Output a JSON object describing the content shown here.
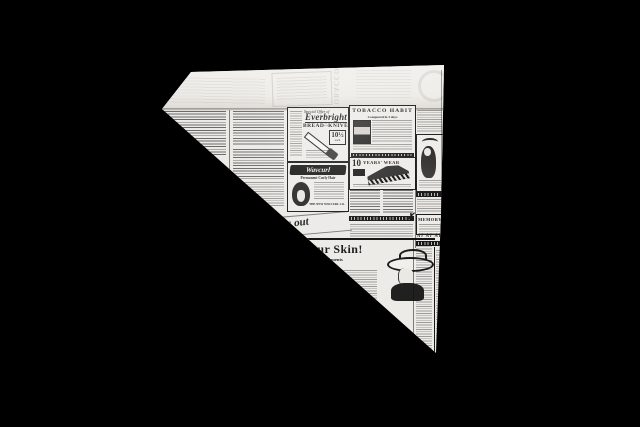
{
  "scene": {
    "description": "Triangular paper cone made of vintage newspaper print, standing on a black background",
    "colors": {
      "background": "#000000",
      "paper": "#eceae6",
      "flap": "#f2f0ec",
      "ink": "#1b1b1b"
    }
  },
  "newsprint": {
    "everbright_ad": {
      "offer": "Special Offer of",
      "brand": "Everbright",
      "title": "BREAD∴KNIVES",
      "price": "10½",
      "price_unit": "each"
    },
    "tobacco_ad": {
      "title": "TOBACCO HABIT",
      "subtitle": "Conquered in 3 days"
    },
    "wavcurl_ad": {
      "brand": "Wavcurl",
      "subtitle": "Permanent Curly Hair",
      "footer": "THE NEW WAVCURL CO."
    },
    "shoe_ad": {
      "number": "10",
      "title": "YEARS' WEAR"
    },
    "cutout_script": {
      "text": "is out"
    },
    "skin_ad": {
      "headline": "our Skin!",
      "line1": "ial Disfigurements",
      "line2": "mplexion",
      "credit": "and Merit",
      "script_fragment": "ne"
    },
    "memory_ad": {
      "title": "MEMORY"
    },
    "fraktur_row": {
      "text": "Al Al Al"
    },
    "ghost_showthrough": {
      "text": "TOBACCO"
    }
  }
}
